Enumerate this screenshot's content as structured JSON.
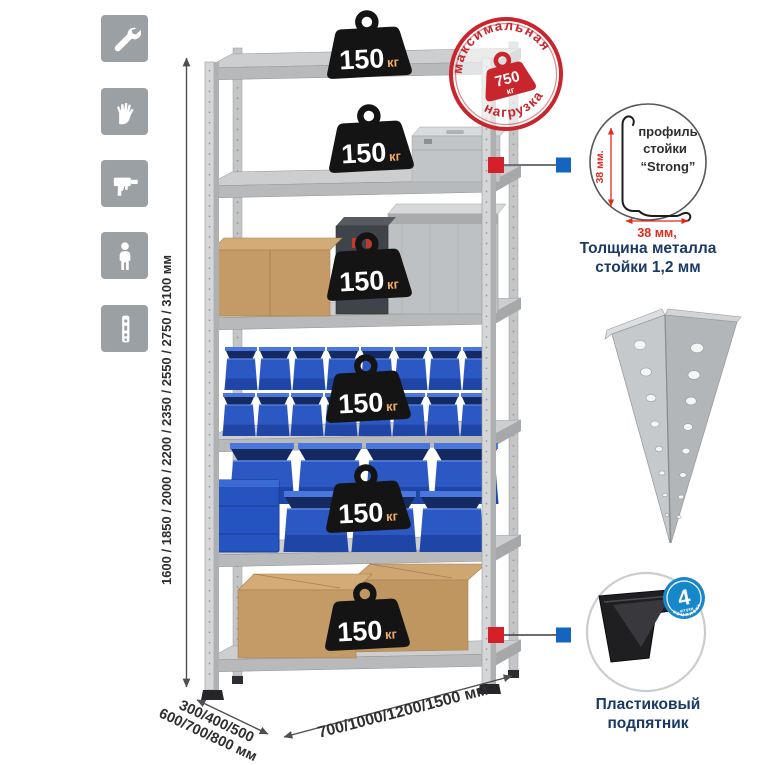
{
  "diagram": {
    "side_icons": {
      "items": [
        {
          "icon": "wrench-icon"
        },
        {
          "icon": "gloves-icon"
        },
        {
          "icon": "drill-icon"
        },
        {
          "icon": "person-icon"
        },
        {
          "icon": "post-profile-icon"
        }
      ]
    },
    "height_dimension": {
      "label": "1600 / 1850 / 2000 / 2200 / 2350 / 2550 / 2750 / 3100 мм"
    },
    "shelf_load": {
      "value": "150",
      "unit": "кг",
      "shelves": 6
    },
    "max_load_stamp": {
      "arc_top": "максимальная",
      "arc_bottom": "нагрузка",
      "value": "750",
      "unit": "кг"
    },
    "strut_profile": {
      "dim_vertical": "38 мм.",
      "dim_horizontal": "38 мм,",
      "label_line1": "профиль",
      "label_line2": "стойки",
      "label_line3": "“Strong”",
      "caption_line1": "Толщина металла",
      "caption_line2": "стойки 1,2 мм"
    },
    "plastic_foot": {
      "badge_value": "4",
      "badge_unit": "штуки",
      "badge_arc": "в комплекте",
      "caption_line1": "Пластиковый",
      "caption_line2": "подпятник"
    },
    "depth_dimension": {
      "line1": "300/400/500",
      "line2": "600/700/800 мм"
    },
    "width_dimension": {
      "label": "700/1000/1200/1500 мм"
    },
    "colors": {
      "stamp_red": "#c8252c",
      "dimension_red": "#e02b20",
      "caption_navy": "#1a3a66",
      "badge_blue": "#1787cb",
      "marker_red": "#d42028",
      "marker_blue": "#1565c0",
      "bin_blue": "#2b58c2",
      "weight_black": "#141414",
      "metal_gray": "#ccced0",
      "icon_tile_gray": "#9ba0a5"
    }
  }
}
